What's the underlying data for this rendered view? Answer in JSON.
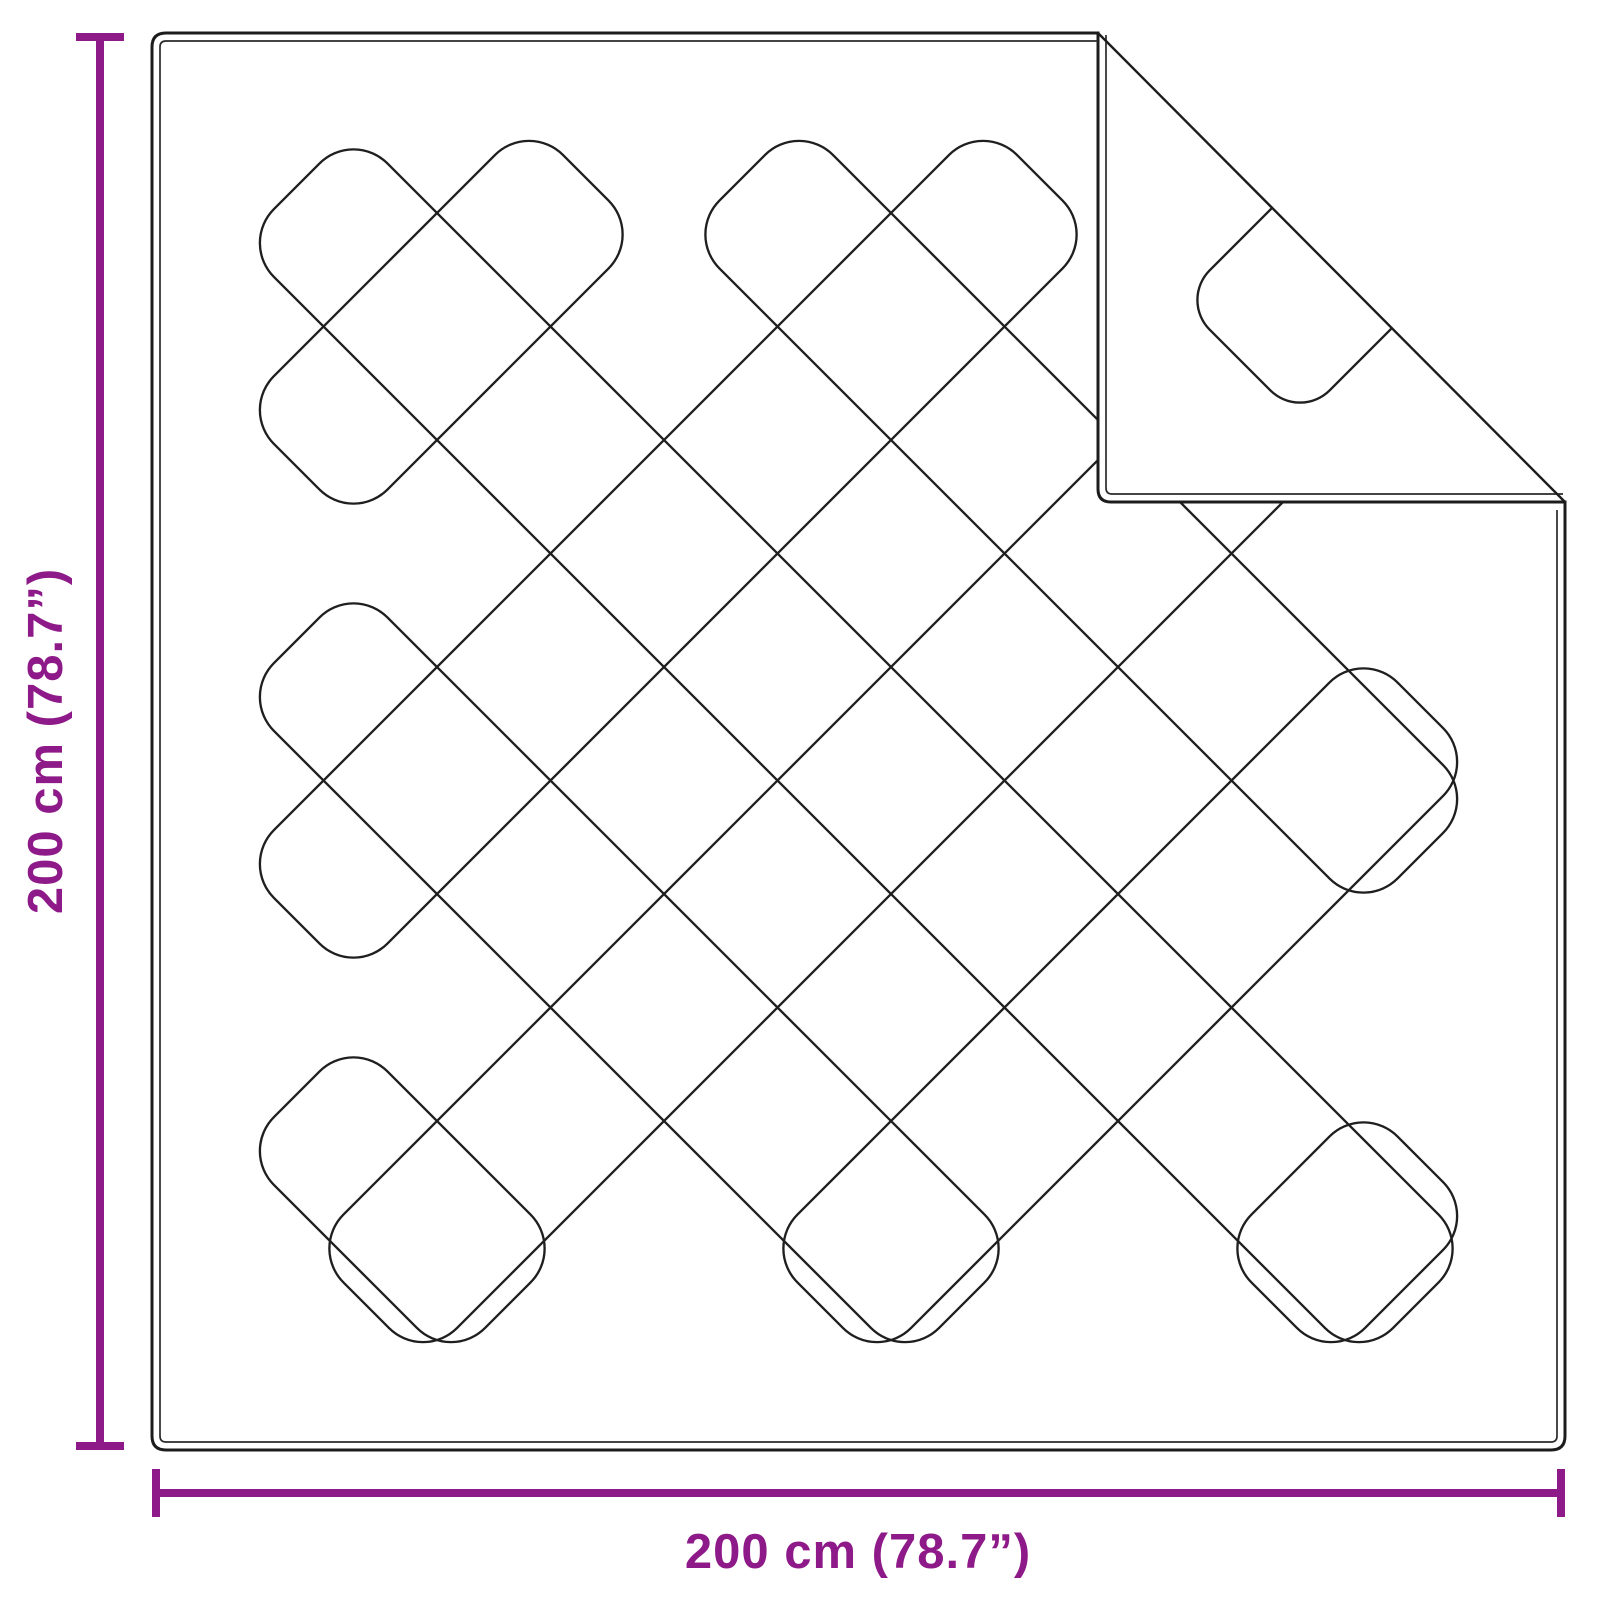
{
  "title": "Blanket dimension diagram",
  "dimensions": {
    "width_label": "200 cm (78.7”)",
    "height_label": "200 cm (78.7”)",
    "width_cm": 200,
    "height_cm": 200,
    "width_in": 78.7,
    "height_in": 78.7
  },
  "colors": {
    "background": "#ffffff",
    "outline": "#1c1c1c",
    "hem": "#2a2a2a",
    "quilt": "#1f1f1f",
    "accent": "#8D1A88"
  },
  "geometry": {
    "canvas": {
      "w": 1600,
      "h": 1600
    },
    "blanket": {
      "x1": 152,
      "y1": 33,
      "x2": 1565,
      "y2": 1450,
      "corner_r": 14,
      "hem_offset": 8,
      "hem_corner_r": 6
    },
    "fold": {
      "x": 1098,
      "y": 502,
      "corner_r": 13
    },
    "quilt": {
      "cell": 227,
      "period": 454,
      "c_anchor": -224,
      "d_anchor": 650,
      "edge_inset": 88,
      "corner_r": 48,
      "k_min": -3,
      "k_max": 3,
      "m_min": -1,
      "m_max": 5,
      "min_len": 110
    },
    "flap_diamond": {
      "cx": 1300,
      "cy": 300,
      "half_diag": 120,
      "corner_r": 42
    },
    "strokes": {
      "outline": 3,
      "hem": 1.7,
      "quilt": 2.35,
      "fold_line": 2.4,
      "dim": 8
    },
    "dim_lines": {
      "left_x": 100,
      "bottom_y": 1493,
      "cap_half_len": 24,
      "left_label_x": 62,
      "left_label_y": 741,
      "bottom_label_x": 858,
      "bottom_label_y": 1568
    }
  }
}
